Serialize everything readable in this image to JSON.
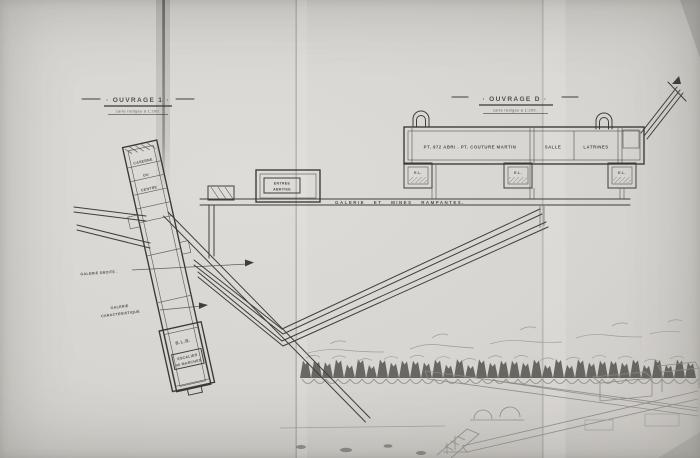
{
  "plan": {
    "left": {
      "title": "· OUVRAGE 1 ·",
      "subtitle": "carte rédigée à 1:200.",
      "room_lines": [
        "CASERNE",
        "DU",
        "CENTRE"
      ],
      "blb": "B.L.B.",
      "stair_line1": "ESCALIER",
      "stair_line2": "40 MARCHES",
      "gallery1": "GALERIE DROITE .",
      "gallery2_line1": "GALERIE",
      "gallery2_line2": "CARACTERISTIQUE"
    },
    "center": {
      "entry_line1": "ENTREE",
      "entry_line2": "ABRITEE",
      "main_gallery": "GALERIE ET MINES RAMPANTES."
    },
    "right": {
      "title": "· OUVRAGE D ·",
      "subtitle": "carte rédigée à 1:200.",
      "barracks_label": "PT. 972 ABRI . PT. COUTURE MARTIN",
      "room_salle": "SALLE",
      "room_latrines": "LATRINES",
      "block_label": "E.L."
    }
  },
  "colors": {
    "paper": "#d7d5d1",
    "ink": "#403e38",
    "pencil": "#8d8b85",
    "tree_band": "#504e48"
  }
}
